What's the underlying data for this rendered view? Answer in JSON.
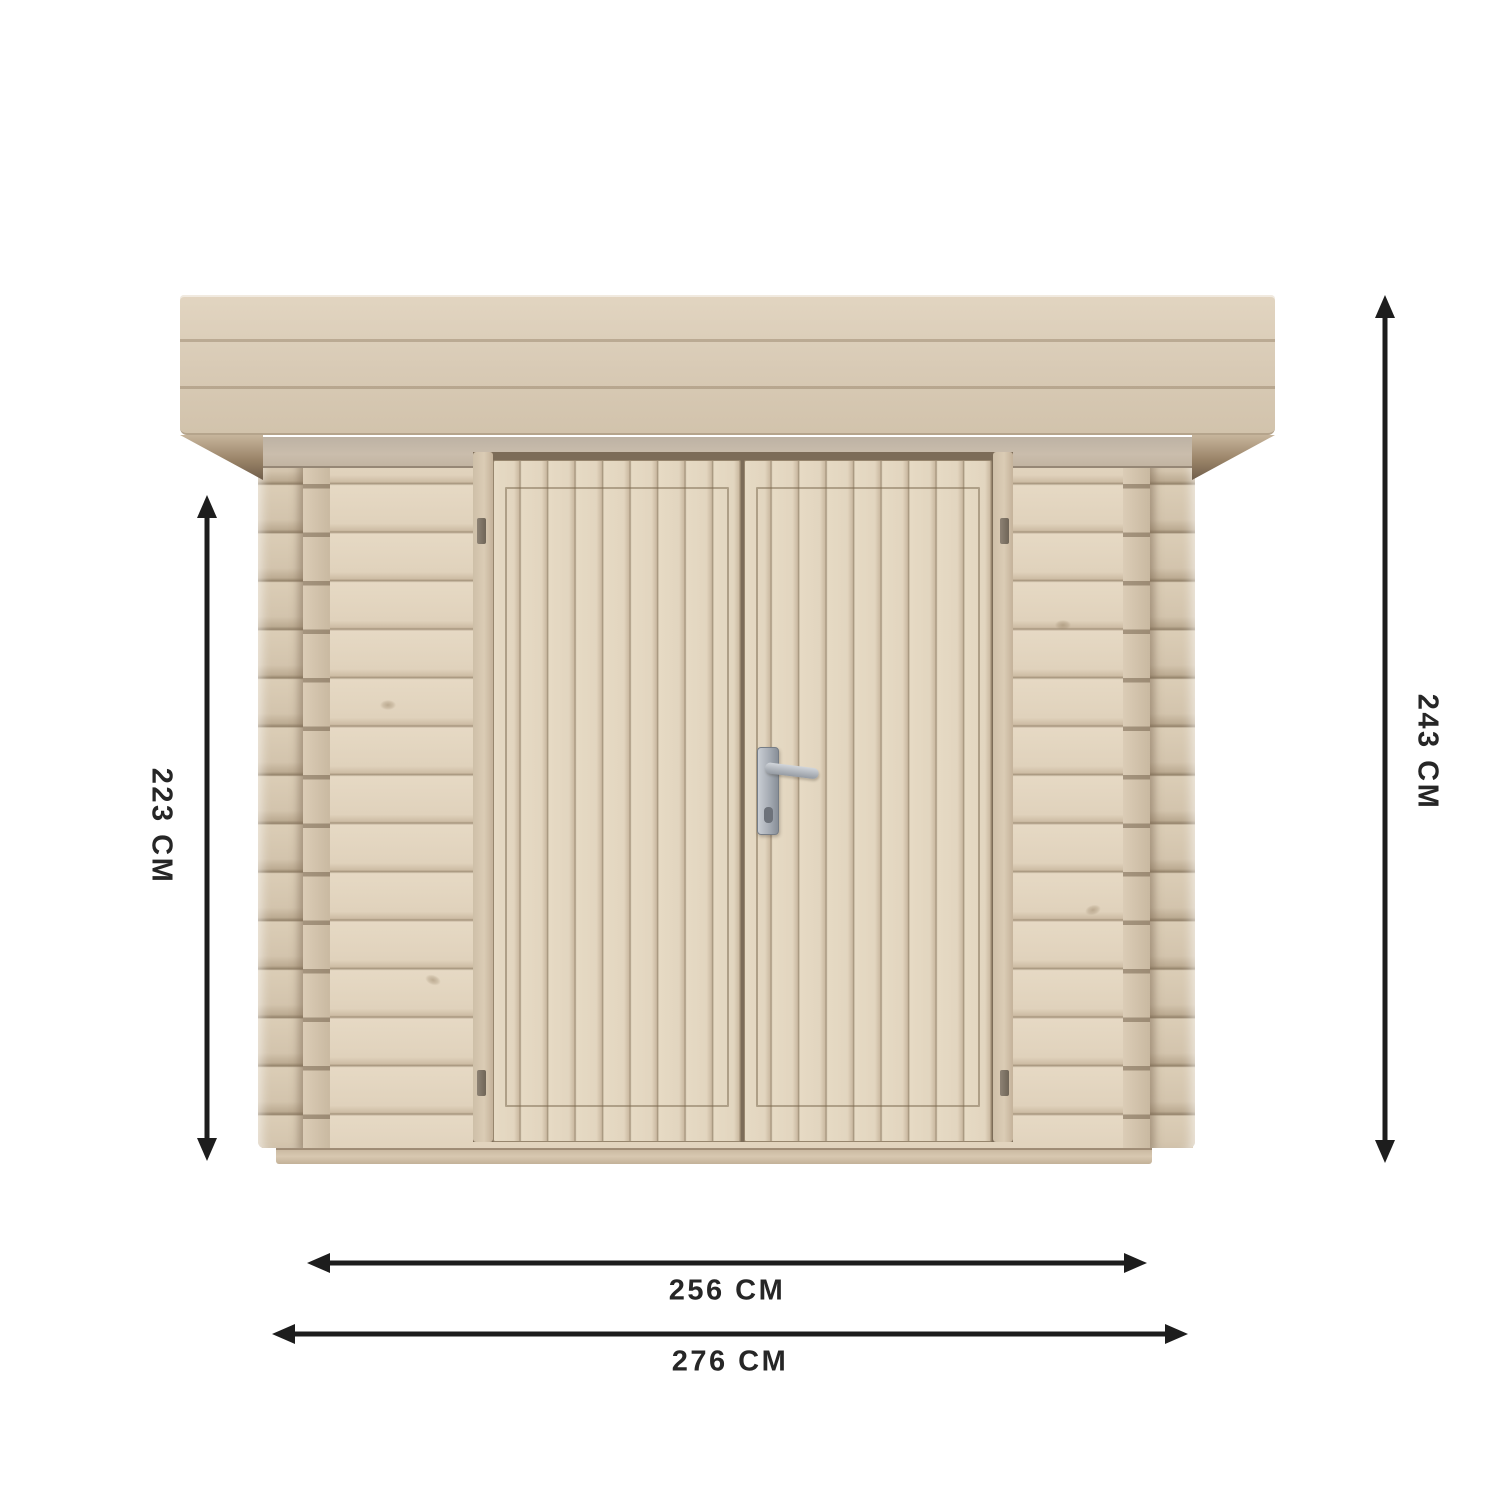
{
  "diagram": {
    "type": "product-dimension-diagram",
    "subject": "wooden garden shed, front elevation with flat roof and double doors",
    "dimensions": {
      "wall_height": "223 CM",
      "overall_height": "243 CM",
      "inner_width": "256 CM",
      "overall_width": "276 CM"
    },
    "icons": {
      "vertical_double_arrow": "↕",
      "horizontal_double_arrow": "↔"
    },
    "colors": {
      "background": "#ffffff",
      "wood_light": "#e6d9c4",
      "wood_mid": "#d8cab5",
      "wood_seam": "#a4937b",
      "lintel_grey": "#c4b7a6",
      "eave_shadow": "#6f5d4a",
      "metal_handle": "#a7adb5",
      "dimension_ink": "#1d1d1d"
    }
  }
}
